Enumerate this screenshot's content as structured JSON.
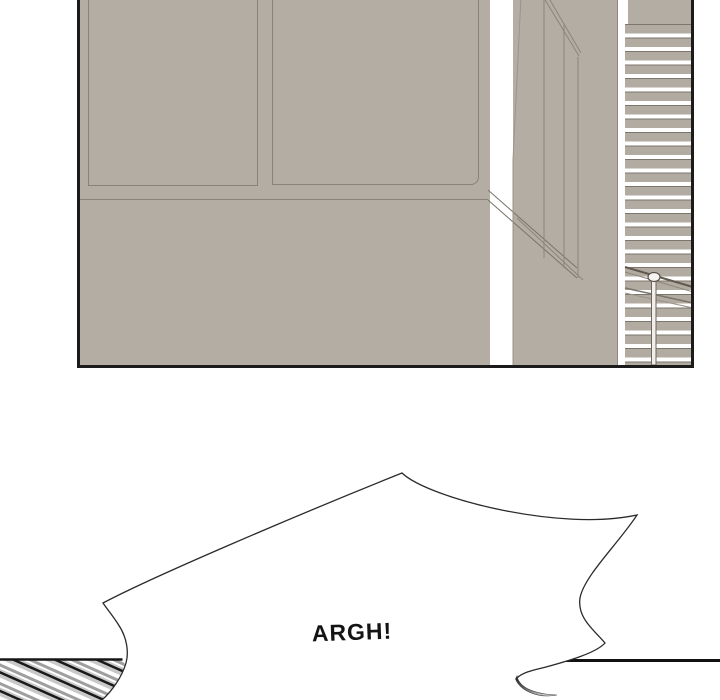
{
  "speech_bubble": {
    "text": "ARGH!"
  },
  "colors": {
    "background": "#ffffff",
    "wall": "#b4ada3",
    "wall_line": "#88827a",
    "stair_step": "#b2aba1",
    "stair_edge": "#7c766d",
    "panel_border": "#1b1b1b",
    "ink_outline": "#2a2a2a",
    "speedline_light_gray": "#c8c8c8",
    "speedline_dark_gray": "#9f9f9f",
    "speedline_black": "#1a1a1a",
    "curl_shadow_dark": "#2e2e2e"
  }
}
